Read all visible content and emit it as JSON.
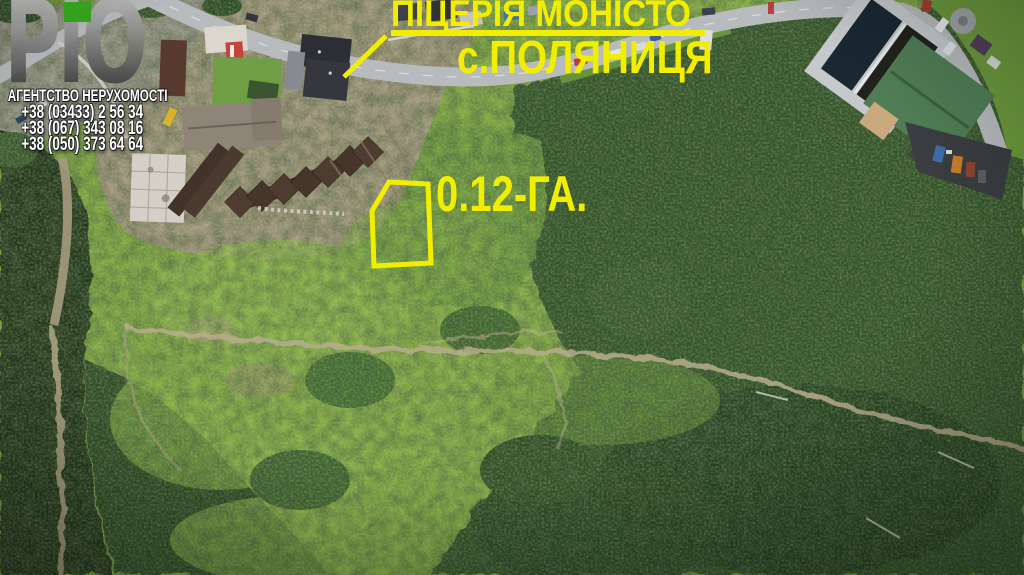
{
  "branding": {
    "logo_text": "РіО",
    "tagline": "АГЕНТСТВО НЕРУХОМОСТІ",
    "phones": [
      "+38 (03433) 2 56 34",
      "+38 (067) 343 08 16",
      "+38 (050) 373 64 64"
    ],
    "logo_accent_color": "#35a01e"
  },
  "annotations": {
    "location_line1": "ПІЦЕРІЯ МОНІСТО",
    "location_line2": "с.ПОЛЯНИЦЯ",
    "area_label": "0.12-ГА.",
    "highlight_color": "#f2ee00"
  }
}
